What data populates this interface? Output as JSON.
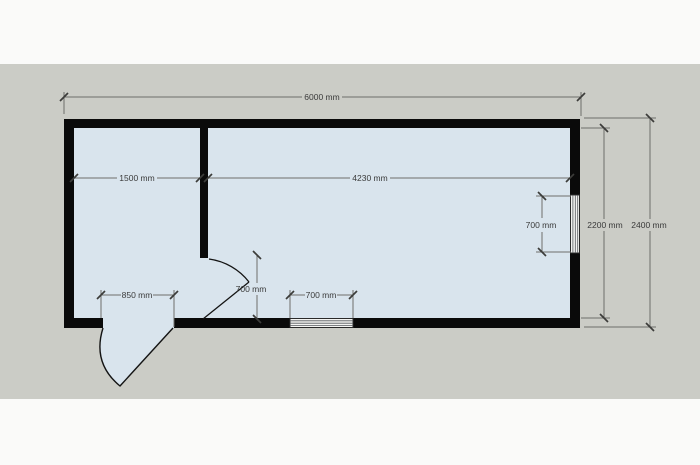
{
  "colors": {
    "canvas": "#cbccc6",
    "band": "#fafaf9",
    "room": "#d9e4ed",
    "wall": "#0a0a0a",
    "dimline": "#6e6e6a",
    "tick": "#3c3c3a",
    "text": "#3a3a3a",
    "windowbg": "#f4f4f2"
  },
  "plan": {
    "dimensions": {
      "overall_width": "6000 mm",
      "left_room_width": "1500 mm",
      "right_room_width": "4230 mm",
      "side_window_height": "700 mm",
      "interior_height": "2200 mm",
      "exterior_height": "2400 mm",
      "entry_door_width": "850 mm",
      "interior_door_width": "700 mm",
      "bottom_window_width": "700 mm"
    }
  }
}
